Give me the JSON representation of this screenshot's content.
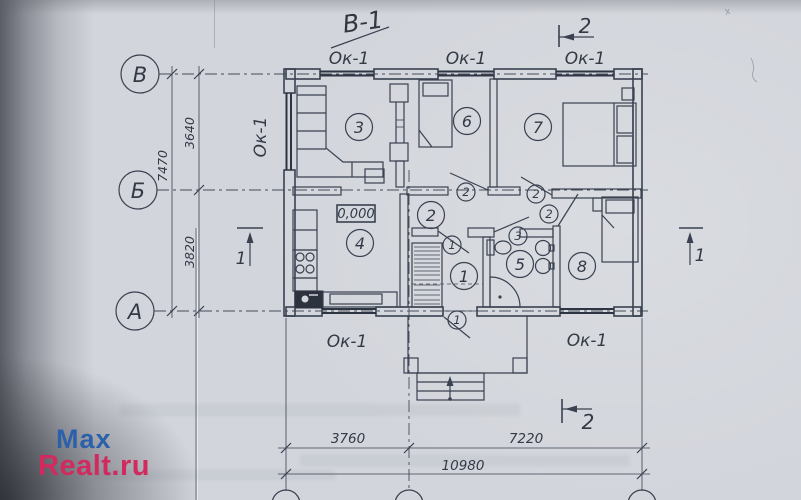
{
  "watermark": {
    "line1": "Max",
    "line2": "Realt.ru",
    "color1": "#2b60ab",
    "color2": "#d22a5e"
  },
  "annotations": {
    "handwritten_title": "В-1",
    "elevation": "0,000"
  },
  "window_tag": {
    "label": "Ок-1"
  },
  "axis_markers": {
    "top": "В",
    "middle": "Б",
    "bottom": "А"
  },
  "dimensions": {
    "left_segment_upper": "3640",
    "left_total": "7470",
    "left_segment_lower": "3820",
    "bottom_segment_left": "3760",
    "bottom_segment_right": "7220",
    "bottom_total": "10980"
  },
  "section_markers": {
    "one": "1",
    "two": "2"
  },
  "rooms": [
    {
      "number": "1"
    },
    {
      "number": "2"
    },
    {
      "number": "3"
    },
    {
      "number": "4"
    },
    {
      "number": "5"
    },
    {
      "number": "6"
    },
    {
      "number": "7"
    },
    {
      "number": "8"
    }
  ],
  "door_tags": {
    "hall_door": "1",
    "front_door": "1",
    "room6_door": "2",
    "room7_door": "2",
    "room8_door": "2",
    "bath_door": "3"
  },
  "drawing_colors": {
    "ink": "#3a4150",
    "paper": "#d2d5db"
  }
}
